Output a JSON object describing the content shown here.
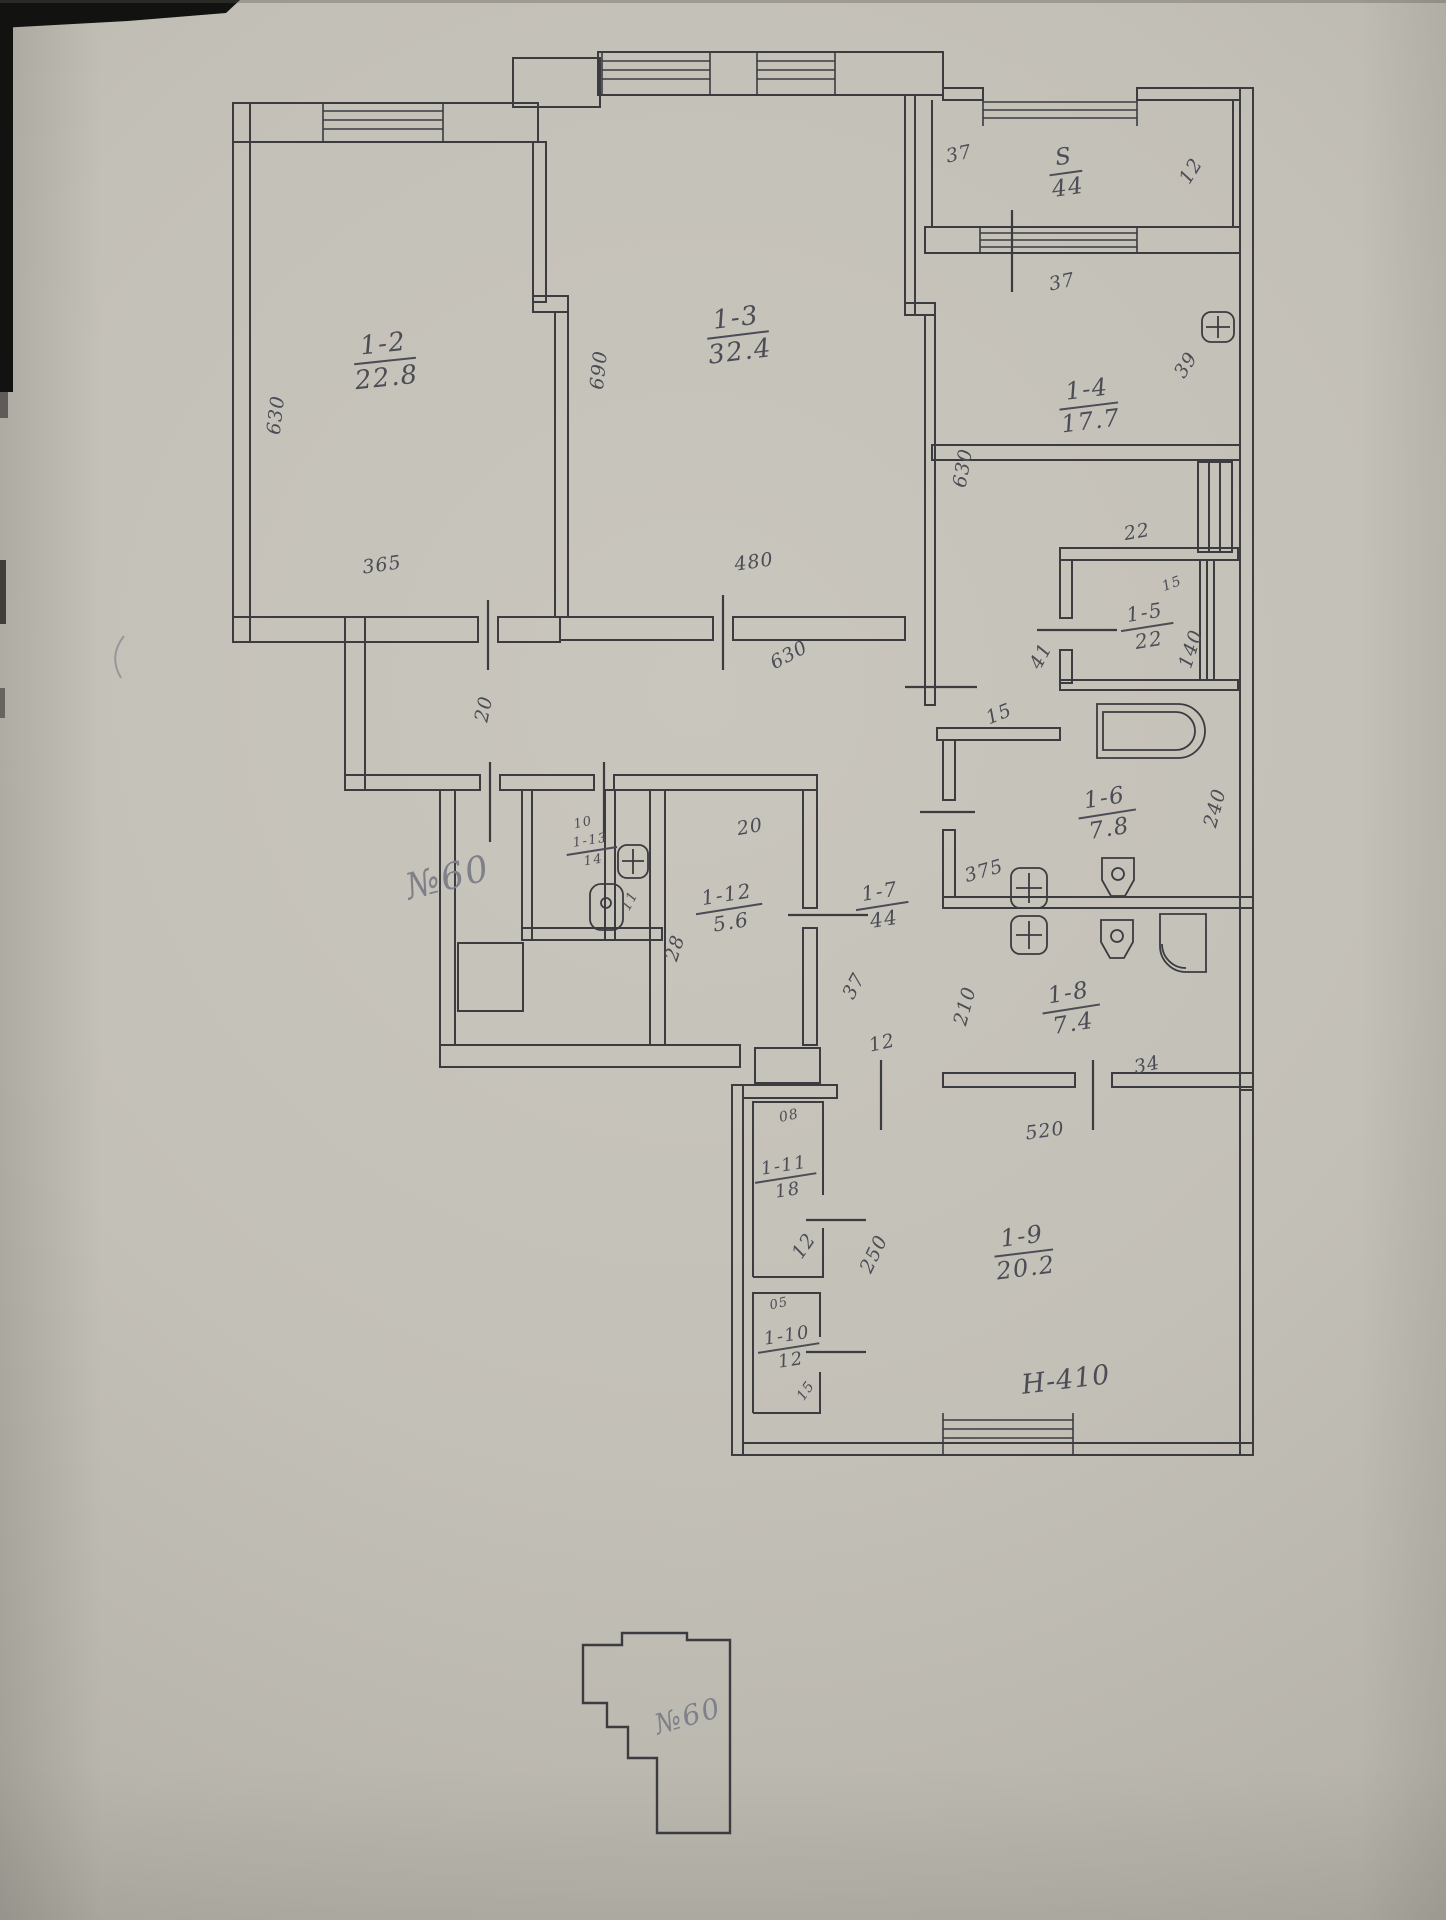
{
  "scan": {
    "ink_color": "#4b4c55",
    "pencil_color": "#7f8089",
    "rooms": [
      {
        "num": "1-2",
        "area": "22.8",
        "x": 385,
        "y": 330,
        "rot": -6,
        "s": 26
      },
      {
        "num": "1-3",
        "area": "32.4",
        "x": 738,
        "y": 304,
        "rot": -7,
        "s": 26
      },
      {
        "num": "1-4",
        "area": "17.7",
        "x": 1089,
        "y": 377,
        "rot": -7,
        "s": 24
      },
      {
        "num": "S",
        "area": "44",
        "x": 1066,
        "y": 145,
        "rot": -8,
        "s": 23
      },
      {
        "num": "1-5",
        "area": "22",
        "x": 1147,
        "y": 602,
        "rot": -9,
        "s": 20
      },
      {
        "num": "1-6",
        "area": "7.8",
        "x": 1107,
        "y": 786,
        "rot": -9,
        "s": 23
      },
      {
        "num": "1-7",
        "area": "44",
        "x": 882,
        "y": 881,
        "rot": -9,
        "s": 20
      },
      {
        "num": "1-8",
        "area": "7.4",
        "x": 1071,
        "y": 981,
        "rot": -9,
        "s": 23
      },
      {
        "num": "1-9",
        "area": "20.2",
        "x": 1024,
        "y": 1224,
        "rot": -7,
        "s": 24
      },
      {
        "num": "1-10",
        "area": "12",
        "x": 789,
        "y": 1326,
        "rot": -9,
        "s": 18
      },
      {
        "num": "1-11",
        "area": "18",
        "x": 786,
        "y": 1156,
        "rot": -9,
        "s": 18
      },
      {
        "num": "1-12",
        "area": "5.6",
        "x": 729,
        "y": 884,
        "rot": -9,
        "s": 20
      },
      {
        "num": "1-13",
        "area": "14",
        "x": 592,
        "y": 834,
        "rot": -9,
        "s": 13
      }
    ],
    "dimensions": [
      {
        "t": "630",
        "x": 276,
        "y": 415,
        "r": -83
      },
      {
        "t": "365",
        "x": 382,
        "y": 565,
        "r": -8
      },
      {
        "t": "690",
        "x": 599,
        "y": 370,
        "r": -84
      },
      {
        "t": "480",
        "x": 754,
        "y": 562,
        "r": -8
      },
      {
        "t": "630",
        "x": 789,
        "y": 655,
        "r": -28
      },
      {
        "t": "630",
        "x": 963,
        "y": 468,
        "r": -80
      },
      {
        "t": "37",
        "x": 959,
        "y": 154,
        "r": -12
      },
      {
        "t": "12",
        "x": 1191,
        "y": 171,
        "r": -58
      },
      {
        "t": "37",
        "x": 1062,
        "y": 282,
        "r": -12
      },
      {
        "t": "39",
        "x": 1186,
        "y": 365,
        "r": -58
      },
      {
        "t": "22",
        "x": 1137,
        "y": 532,
        "r": -10
      },
      {
        "t": "15",
        "x": 1172,
        "y": 584,
        "r": -20,
        "s": 14
      },
      {
        "t": "140",
        "x": 1191,
        "y": 649,
        "r": -72
      },
      {
        "t": "41",
        "x": 1041,
        "y": 656,
        "r": -62
      },
      {
        "t": "15",
        "x": 999,
        "y": 714,
        "r": -22
      },
      {
        "t": "20",
        "x": 484,
        "y": 709,
        "r": -78
      },
      {
        "t": "10",
        "x": 583,
        "y": 823,
        "r": -12,
        "s": 13
      },
      {
        "t": "11",
        "x": 630,
        "y": 901,
        "r": -62,
        "s": 14
      },
      {
        "t": "20",
        "x": 750,
        "y": 827,
        "r": -10
      },
      {
        "t": "28",
        "x": 675,
        "y": 948,
        "r": -72
      },
      {
        "t": "375",
        "x": 984,
        "y": 871,
        "r": -16
      },
      {
        "t": "240",
        "x": 1215,
        "y": 808,
        "r": -75
      },
      {
        "t": "210",
        "x": 965,
        "y": 1006,
        "r": -75
      },
      {
        "t": "34",
        "x": 1147,
        "y": 1065,
        "r": -12
      },
      {
        "t": "520",
        "x": 1045,
        "y": 1131,
        "r": -8
      },
      {
        "t": "12",
        "x": 882,
        "y": 1043,
        "r": -12
      },
      {
        "t": "37",
        "x": 854,
        "y": 986,
        "r": -62
      },
      {
        "t": "08",
        "x": 789,
        "y": 1116,
        "r": -12,
        "s": 14
      },
      {
        "t": "12",
        "x": 804,
        "y": 1246,
        "r": -55
      },
      {
        "t": "05",
        "x": 779,
        "y": 1304,
        "r": -12,
        "s": 13
      },
      {
        "t": "15",
        "x": 806,
        "y": 1391,
        "r": -55,
        "s": 14
      },
      {
        "t": "250",
        "x": 874,
        "y": 1254,
        "r": -64
      },
      {
        "t": "H-410",
        "x": 1066,
        "y": 1380,
        "r": -7,
        "s": 27
      }
    ],
    "annotations": [
      {
        "t": "№60",
        "x": 448,
        "y": 878,
        "r": -14,
        "s": 36
      },
      {
        "t": "№60",
        "x": 688,
        "y": 1716,
        "r": -16,
        "s": 28
      }
    ]
  }
}
